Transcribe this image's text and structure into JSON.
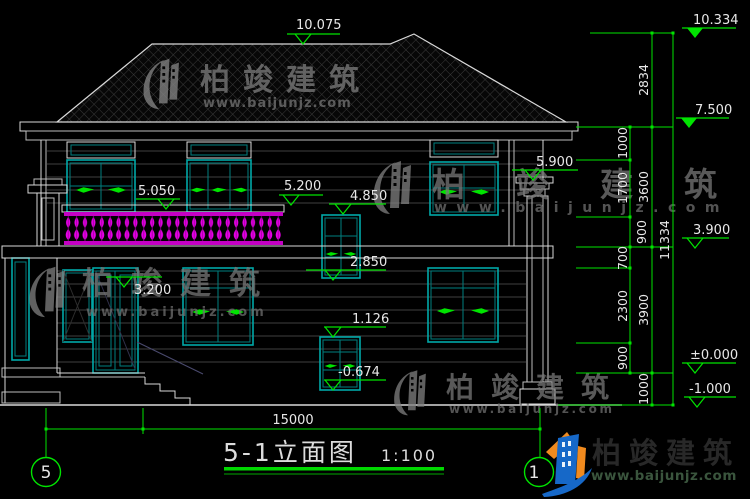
{
  "title": {
    "name": "5-1立面图",
    "scale": "1:100"
  },
  "levels_building": {
    "ridge": "10.075",
    "balcony_rail": "5.050",
    "wall_mid": "5.200",
    "stair_win_top": "4.850",
    "stair_win_bottom": "2.850",
    "porch": "3.200",
    "eave_right": "5.900",
    "base_win_top": "1.126",
    "base_win_bottom": "-0.674"
  },
  "levels_right": {
    "roof_top": "10.334",
    "second_eave": "7.500",
    "first_ceiling": "3.900",
    "ground": "±0.000",
    "site": "-1.000"
  },
  "dims": {
    "inner": [
      "1000",
      "1700",
      "900",
      "700",
      "2300",
      "900"
    ],
    "middle": [
      "2834",
      "3600",
      "3900",
      "1000"
    ],
    "overall_height": "11334",
    "overall_width": "15000"
  },
  "bubbles": {
    "left": "5",
    "right": "1"
  },
  "watermark": {
    "brand": "柏竣建筑",
    "url": "www.baijunjz.com"
  },
  "brand": {
    "name": "柏竣建筑",
    "url": "www.baijunjz.com"
  },
  "colors": {
    "dimension_green": "#00e400",
    "window_cyan": "#00a8a8",
    "baluster_magenta": "#e800e8",
    "brand_blue": "#1668c8",
    "brand_orange": "#f08a1e"
  }
}
